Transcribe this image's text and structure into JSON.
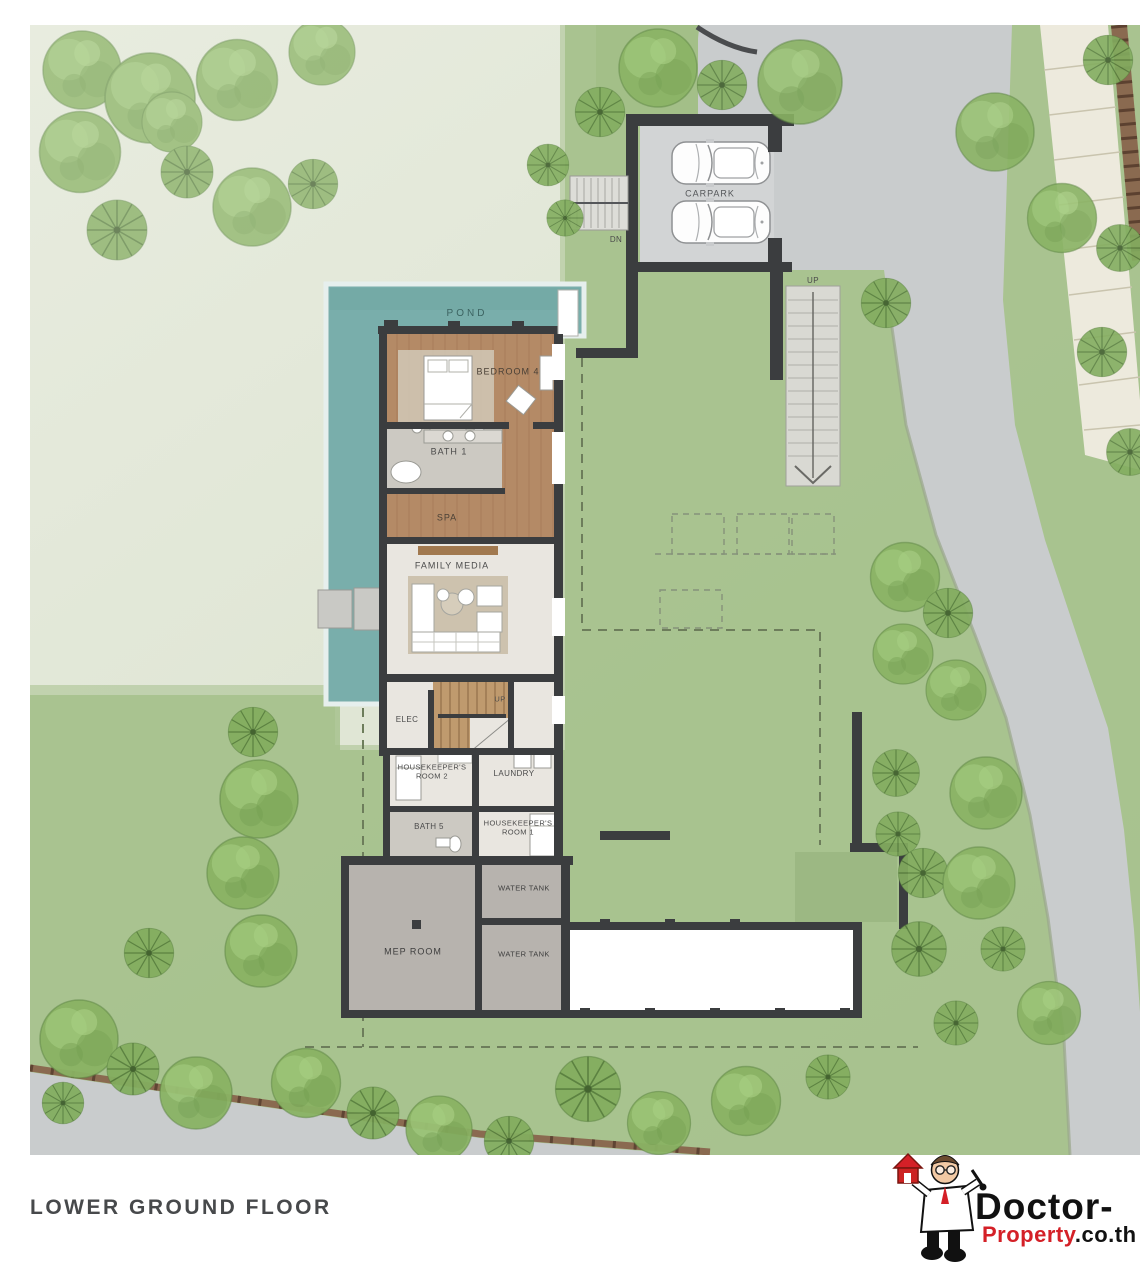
{
  "labels": {
    "pond": "POND",
    "bedroom4": "BEDROOM 4",
    "bath1": "BATH 1",
    "spa": "SPA",
    "family_media": "FAMILY MEDIA",
    "elec": "ELEC",
    "stairs_up": "UP",
    "housekeeper2_l1": "HOUSEKEEPER'S",
    "housekeeper2_l2": "ROOM 2",
    "laundry": "LAUNDRY",
    "bath5": "BATH 5",
    "housekeeper1_l1": "HOUSEKEEPER'S",
    "housekeeper1_l2": "ROOM 1",
    "water_tank_upper": "WATER TANK",
    "water_tank_lower": "WATER TANK",
    "mep_room": "MEP ROOM",
    "carpark": "CARPARK",
    "stairs_dn": "DN",
    "garden_stairs_up": "UP",
    "floor_title": "LOWER GROUND FLOOR"
  },
  "watermark": {
    "brand_top": "Doctor-",
    "brand_bottom_red": "Property",
    "brand_bottom_suffix": ".co.th"
  },
  "colors": {
    "site_pale": "#e4e9dc",
    "lawn_green": "#a6c08d",
    "pond_teal": "#79aeab",
    "road_gray": "#c9cccd",
    "wall_dark": "#3b3d3f",
    "wood_floor": "#b48a66",
    "utility_gray": "#b7b3ae",
    "brand_red": "#d42027"
  }
}
